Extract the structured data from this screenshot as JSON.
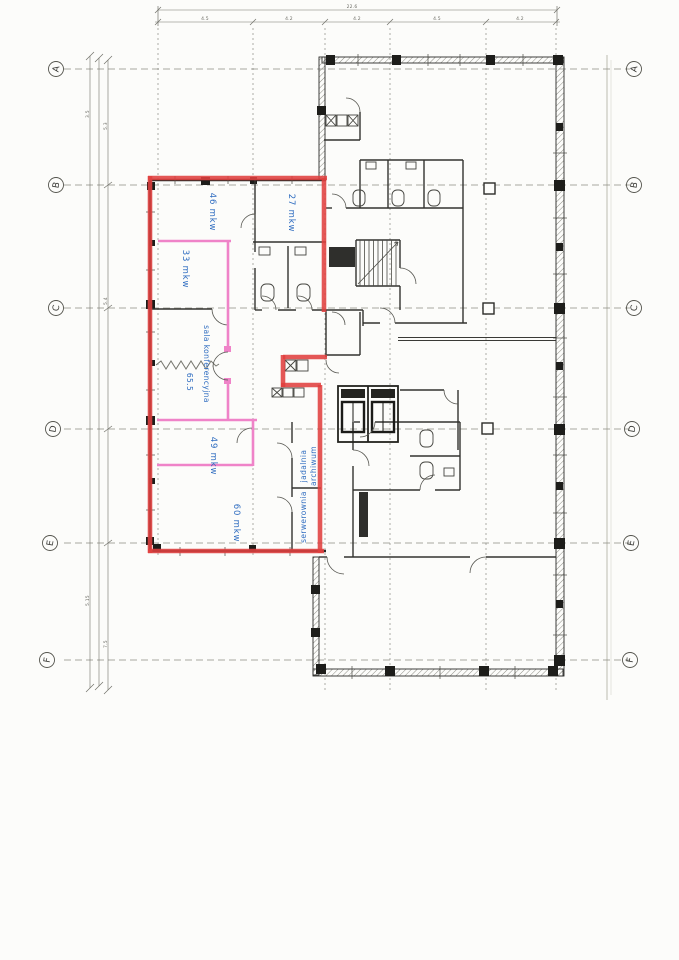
{
  "document": {
    "type": "scanned floor plan with highlighted lease area",
    "grid_rows": [
      "A",
      "B",
      "C",
      "D",
      "E",
      "F"
    ],
    "rooms": {
      "room46": "46 mkw",
      "room27": "27 mkw",
      "room33": "33 mkw",
      "conference_name": "sala konferencyjna",
      "conference_area": "65.5",
      "room49": "49 mkw",
      "room60": "60 mkw",
      "archive": "archiwum",
      "dining": "jadalnia",
      "server_room": "serwerownia"
    },
    "dimensions": {
      "overall_top": "22.6",
      "top_segments": [
        "4.5",
        "4.2",
        "4.2",
        "4.5",
        "4.2"
      ],
      "left_marks": [
        "3.5",
        "5.3",
        "5.4",
        "5.15",
        "7.5"
      ]
    },
    "colors": {
      "highlight_red": "#e0403f",
      "highlight_pink": "#ef83c8",
      "label_blue": "#2e6cc0",
      "ink_black": "#2b2b28",
      "paper": "#fcfcfa"
    }
  }
}
